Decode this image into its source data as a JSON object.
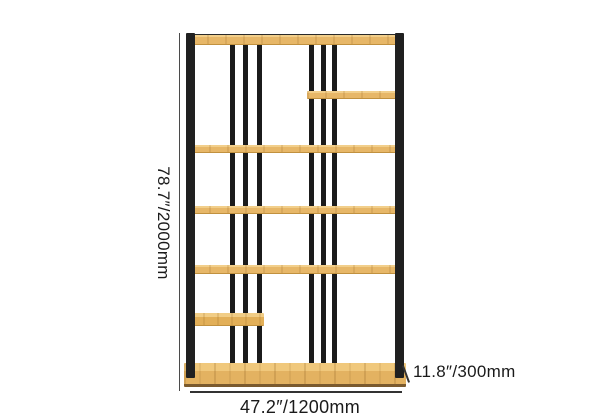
{
  "diagram": {
    "type": "product-dimension-diagram",
    "product": "etagere-bookshelf",
    "labels": {
      "height": "78.7″/2000mm",
      "width": "47.2″/1200mm",
      "depth": "11.8″/300mm"
    },
    "structure": {
      "full_shelves": 5,
      "small_shelves": 2,
      "vertical_slats": 6,
      "frame_posts": 2
    },
    "colors": {
      "background": "#ffffff",
      "metal_frame": "#202020",
      "wood_top": "#f2cf8b",
      "wood_body": "#e7b768",
      "wood_front": "#e3b261",
      "wood_edge": "#c1913f",
      "base_bottom_edge": "#7a5a2e",
      "dimension_line": "#3c3c3c",
      "label_text": "#1a1a1a"
    }
  }
}
